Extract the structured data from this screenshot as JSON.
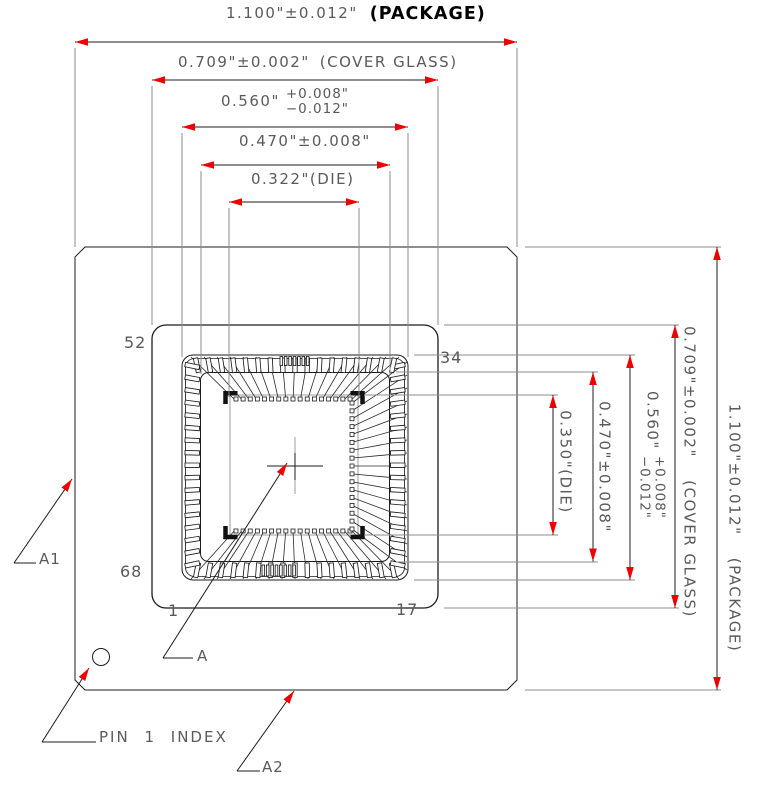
{
  "colors": {
    "arrow_red": "#ee0000",
    "line_black": "#1c1c1c",
    "ext_gray": "#8c8c8c",
    "text_gray": "#5a5a5a",
    "die_gray": "#9e9e9e"
  },
  "dimensions": {
    "top": [
      {
        "value": "1.100\"±0.012\"",
        "note": "(PACKAGE)"
      },
      {
        "value": "0.709\"±0.002\"",
        "note": "(COVER GLASS)"
      },
      {
        "value": "0.560\"",
        "tol_plus": "+0.008\"",
        "tol_minus": "−0.012\""
      },
      {
        "value": "0.470\"±0.008\""
      },
      {
        "value": "0.322\"(DIE)"
      }
    ],
    "right": [
      {
        "value": "0.350\"(DIE)"
      },
      {
        "value": "0.470\"±0.008\""
      },
      {
        "value": "0.560\"",
        "tol_plus": "+0.008\"",
        "tol_minus": "−0.012\""
      },
      {
        "value": "0.709\"±0.002\"",
        "note": "(COVER GLASS)"
      },
      {
        "value": "1.100\"±0.012\"",
        "note": "(PACKAGE)"
      }
    ]
  },
  "pins": {
    "top_left": "52",
    "top_right": "34",
    "bottom_left": "68",
    "bottom_row_start": "1",
    "bottom_row_end": "17"
  },
  "callouts": {
    "center_mark": "A",
    "left_edge": "A1",
    "bottom_edge": "A2",
    "pin_one": "PIN 1 INDEX"
  }
}
